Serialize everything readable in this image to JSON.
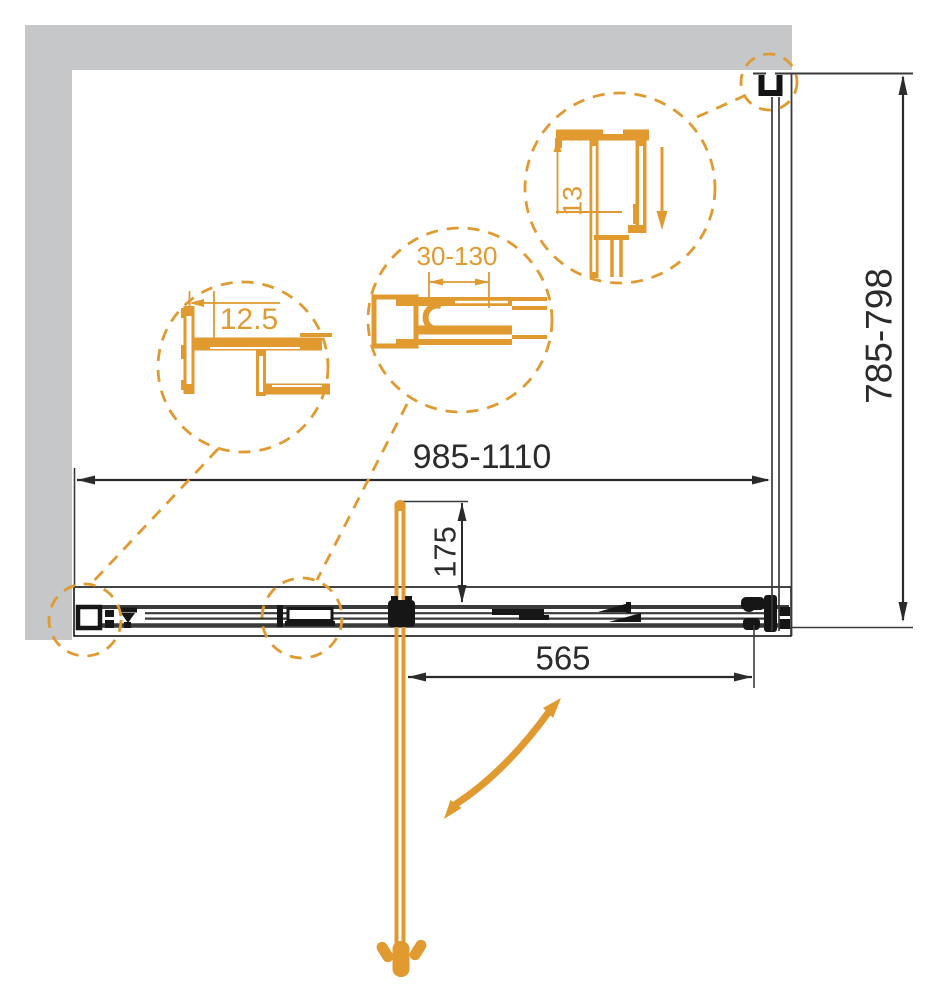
{
  "drawing": {
    "title": "Shower enclosure plan drawing",
    "dimensions": {
      "width_range": "985-1110",
      "depth_range": "785-798",
      "door_width": "565",
      "door_offset": "175"
    },
    "details": {
      "left_profile": "12.5",
      "middle_profile": "30-130",
      "right_profile": "13"
    },
    "colors": {
      "accent": "#E09A30",
      "wall": "#C5C7C9",
      "line": "#2B2B2B"
    }
  }
}
